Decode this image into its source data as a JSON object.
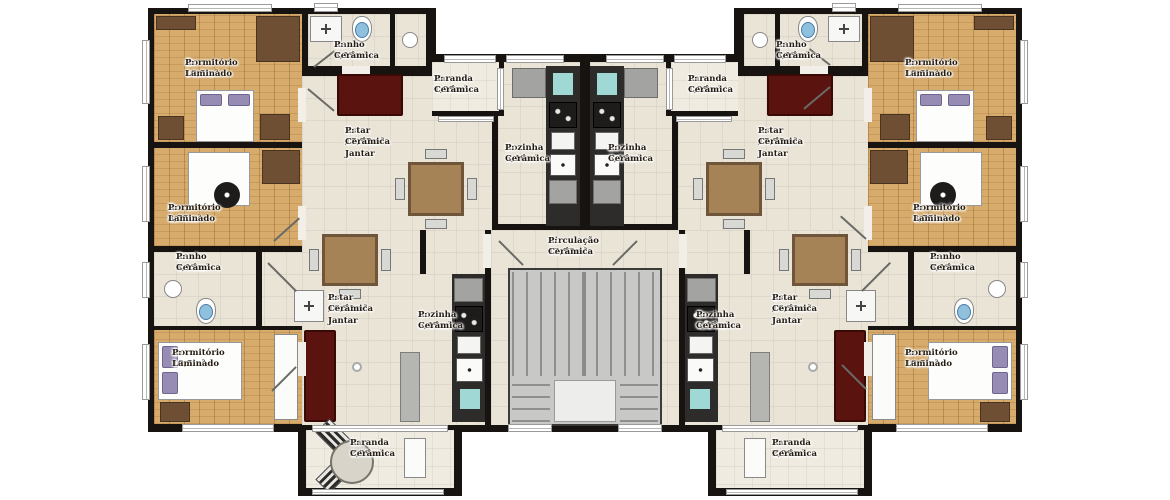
{
  "plan": {
    "rooms": {
      "dorm_top": {
        "name": "Dormitório",
        "area": "A: 10,5m²",
        "floor": "P: Laminado"
      },
      "dorm_mid": {
        "name": "Dormitório",
        "area": "A: 8,75m²",
        "floor": "P: Laminado"
      },
      "dorm_bottom": {
        "name": "Dormitório",
        "area": "A: 10,5m²",
        "floor": "P: Laminado"
      },
      "banho_top": {
        "name": "Banho",
        "area": "A: 3,13m²",
        "floor": "P: Cerâmica"
      },
      "banho_mid": {
        "name": "Banho",
        "area": "A: 3,13m²",
        "floor": "P: Cerâmica"
      },
      "varanda_top": {
        "name": "Varanda",
        "area": "A: 1,95m²",
        "floor": "P: Cerâmica"
      },
      "varanda_bottom": {
        "name": "Varanda",
        "area": "A: 2,99m²",
        "floor": "P: Cerâmica"
      },
      "estar_top": {
        "name": "Estar / Jantar",
        "area": "A: 15,75m²",
        "floor": "P: Cerâmica"
      },
      "estar_bottom": {
        "name": "Estar / Jantar",
        "area": "A: 16,21m²",
        "floor": "P: Cerâmica"
      },
      "cozinha_top": {
        "name": "Cozinha",
        "area": "A: 6,46m²",
        "floor": "P: Cerâmica"
      },
      "cozinha_bottom": {
        "name": "Cozinha",
        "area": "A: 6,47m²",
        "floor": "P: Cerâmica"
      },
      "circulacao": {
        "name": "Circulação",
        "area": "A: 12,53m²",
        "floor": "P: Cerâmica"
      }
    },
    "colors": {
      "wall": "#171310",
      "floor_ceramic": "#eae4d7",
      "floor_wood": "#d6ab6b",
      "balcony": "#f0ebe0",
      "sofa": "#5a130e",
      "stair": "#c8c8c6",
      "counter": "#2e2c2a",
      "appliance_gray": "#a3a3a1",
      "fixture_blue": "#8fc0dd",
      "fixture_teal": "#9fd8d4"
    }
  }
}
